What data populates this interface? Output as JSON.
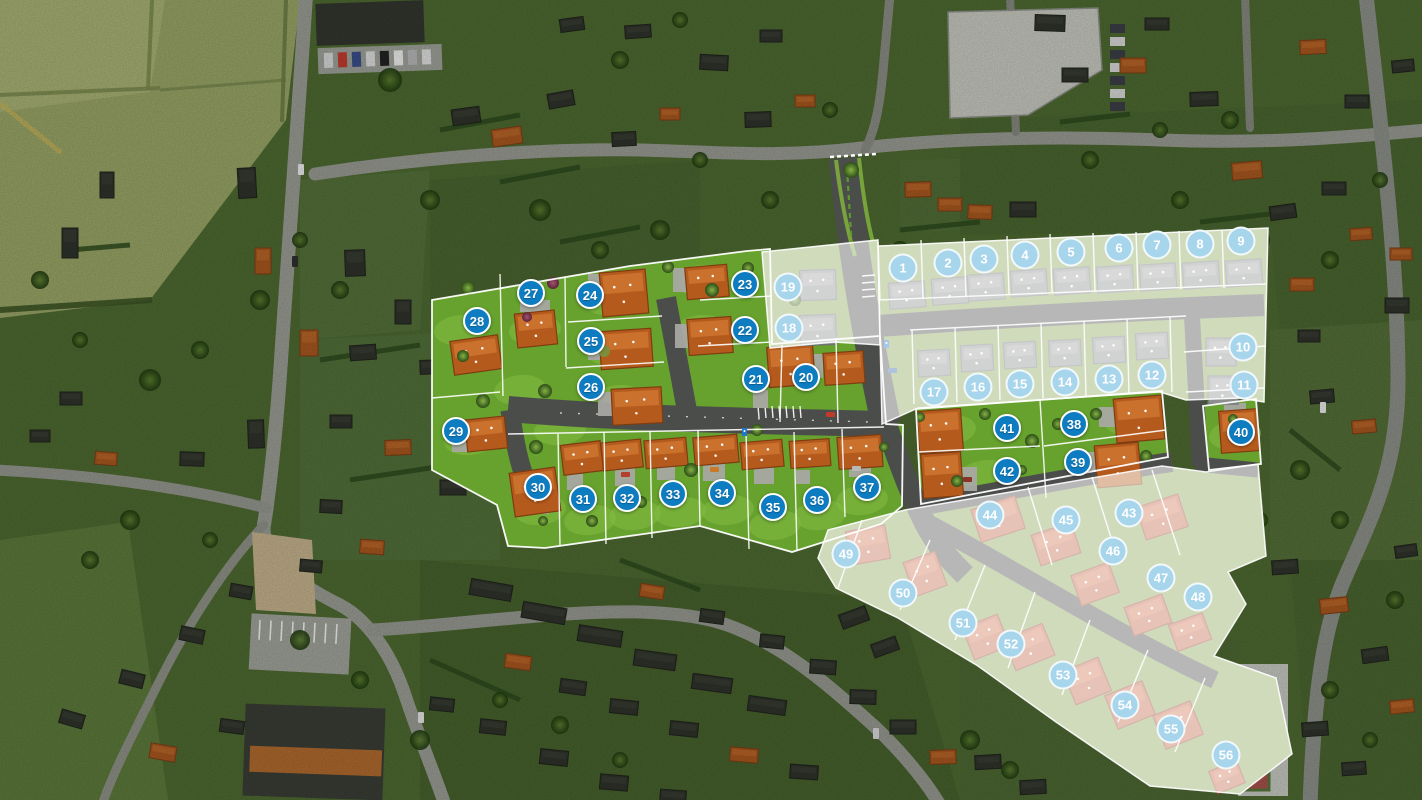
{
  "map": {
    "kind": "residential-lotissement-site-plan-on-aerial-photo",
    "marker_colors": {
      "active": "#0d7cc1",
      "future": "#a7d5ec"
    },
    "phase_styles": {
      "future_overlay": "rgba(255,255,255,0.60)",
      "active_grass": "#66a22d",
      "future_grass": "#8ba557",
      "plan_road": "#4b4d4b"
    },
    "lots": [
      {
        "number": "1",
        "x": 903,
        "y": 268,
        "phase": "future"
      },
      {
        "number": "2",
        "x": 948,
        "y": 263,
        "phase": "future"
      },
      {
        "number": "3",
        "x": 984,
        "y": 259,
        "phase": "future"
      },
      {
        "number": "4",
        "x": 1025,
        "y": 255,
        "phase": "future"
      },
      {
        "number": "5",
        "x": 1071,
        "y": 252,
        "phase": "future"
      },
      {
        "number": "6",
        "x": 1119,
        "y": 248,
        "phase": "future"
      },
      {
        "number": "7",
        "x": 1157,
        "y": 245,
        "phase": "future"
      },
      {
        "number": "8",
        "x": 1200,
        "y": 244,
        "phase": "future"
      },
      {
        "number": "9",
        "x": 1241,
        "y": 241,
        "phase": "future"
      },
      {
        "number": "10",
        "x": 1243,
        "y": 347,
        "phase": "future"
      },
      {
        "number": "11",
        "x": 1244,
        "y": 385,
        "phase": "future"
      },
      {
        "number": "12",
        "x": 1152,
        "y": 375,
        "phase": "future"
      },
      {
        "number": "13",
        "x": 1109,
        "y": 379,
        "phase": "future"
      },
      {
        "number": "14",
        "x": 1065,
        "y": 382,
        "phase": "future"
      },
      {
        "number": "15",
        "x": 1020,
        "y": 384,
        "phase": "future"
      },
      {
        "number": "16",
        "x": 978,
        "y": 387,
        "phase": "future"
      },
      {
        "number": "17",
        "x": 934,
        "y": 392,
        "phase": "future"
      },
      {
        "number": "18",
        "x": 789,
        "y": 328,
        "phase": "future"
      },
      {
        "number": "19",
        "x": 788,
        "y": 287,
        "phase": "future"
      },
      {
        "number": "20",
        "x": 806,
        "y": 377,
        "phase": "active"
      },
      {
        "number": "21",
        "x": 756,
        "y": 379,
        "phase": "active"
      },
      {
        "number": "22",
        "x": 745,
        "y": 330,
        "phase": "active"
      },
      {
        "number": "23",
        "x": 745,
        "y": 284,
        "phase": "active"
      },
      {
        "number": "24",
        "x": 590,
        "y": 295,
        "phase": "active"
      },
      {
        "number": "25",
        "x": 591,
        "y": 341,
        "phase": "active"
      },
      {
        "number": "26",
        "x": 591,
        "y": 387,
        "phase": "active"
      },
      {
        "number": "27",
        "x": 531,
        "y": 293,
        "phase": "active"
      },
      {
        "number": "28",
        "x": 477,
        "y": 321,
        "phase": "active"
      },
      {
        "number": "29",
        "x": 456,
        "y": 431,
        "phase": "active"
      },
      {
        "number": "30",
        "x": 538,
        "y": 487,
        "phase": "active"
      },
      {
        "number": "31",
        "x": 583,
        "y": 499,
        "phase": "active"
      },
      {
        "number": "32",
        "x": 627,
        "y": 498,
        "phase": "active"
      },
      {
        "number": "33",
        "x": 673,
        "y": 494,
        "phase": "active"
      },
      {
        "number": "34",
        "x": 722,
        "y": 493,
        "phase": "active"
      },
      {
        "number": "35",
        "x": 773,
        "y": 507,
        "phase": "active"
      },
      {
        "number": "36",
        "x": 817,
        "y": 500,
        "phase": "active"
      },
      {
        "number": "37",
        "x": 867,
        "y": 487,
        "phase": "active"
      },
      {
        "number": "38",
        "x": 1074,
        "y": 424,
        "phase": "active"
      },
      {
        "number": "39",
        "x": 1078,
        "y": 462,
        "phase": "active"
      },
      {
        "number": "40",
        "x": 1241,
        "y": 432,
        "phase": "active"
      },
      {
        "number": "41",
        "x": 1007,
        "y": 428,
        "phase": "active"
      },
      {
        "number": "42",
        "x": 1007,
        "y": 471,
        "phase": "active"
      },
      {
        "number": "43",
        "x": 1129,
        "y": 513,
        "phase": "future"
      },
      {
        "number": "44",
        "x": 990,
        "y": 515,
        "phase": "future"
      },
      {
        "number": "45",
        "x": 1066,
        "y": 520,
        "phase": "future"
      },
      {
        "number": "46",
        "x": 1113,
        "y": 551,
        "phase": "future"
      },
      {
        "number": "47",
        "x": 1161,
        "y": 578,
        "phase": "future"
      },
      {
        "number": "48",
        "x": 1198,
        "y": 597,
        "phase": "future"
      },
      {
        "number": "49",
        "x": 846,
        "y": 554,
        "phase": "future"
      },
      {
        "number": "50",
        "x": 903,
        "y": 593,
        "phase": "future"
      },
      {
        "number": "51",
        "x": 963,
        "y": 623,
        "phase": "future"
      },
      {
        "number": "52",
        "x": 1011,
        "y": 644,
        "phase": "future"
      },
      {
        "number": "53",
        "x": 1063,
        "y": 675,
        "phase": "future"
      },
      {
        "number": "54",
        "x": 1125,
        "y": 705,
        "phase": "future"
      },
      {
        "number": "55",
        "x": 1171,
        "y": 729,
        "phase": "future"
      },
      {
        "number": "56",
        "x": 1226,
        "y": 755,
        "phase": "future"
      }
    ]
  }
}
